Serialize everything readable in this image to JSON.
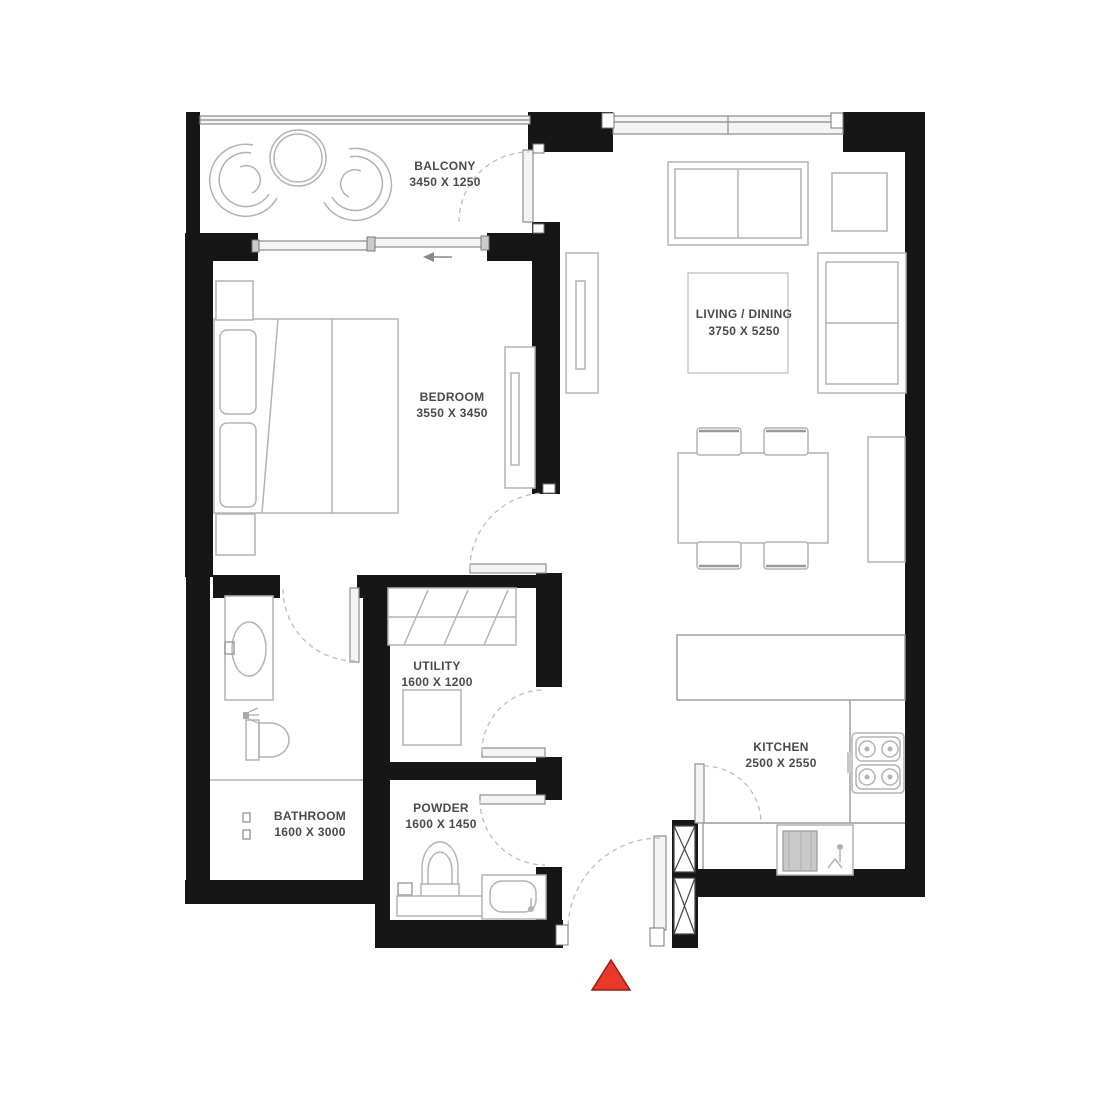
{
  "rooms": [
    {
      "name": "BALCONY",
      "dimensions": "3450 X 1250"
    },
    {
      "name": "BEDROOM",
      "dimensions": "3550 X 3450"
    },
    {
      "name": "LIVING / DINING",
      "dimensions": "3750 X 5250"
    },
    {
      "name": "BATHROOM",
      "dimensions": "1600 X 3000"
    },
    {
      "name": "UTILITY",
      "dimensions": "1600 X 1200"
    },
    {
      "name": "POWDER",
      "dimensions": "1600 X 1450"
    },
    {
      "name": "KITCHEN",
      "dimensions": "2500 X 2550"
    }
  ],
  "colors": {
    "wall": "#161616",
    "furniture_line": "#b3b3b3",
    "label_text": "#4a4a4a",
    "entry_marker_fill": "#e8392b",
    "entry_marker_border": "#9c1b10"
  },
  "icons": {
    "entry_marker": "red-triangle",
    "slide_direction": "left-arrow"
  }
}
